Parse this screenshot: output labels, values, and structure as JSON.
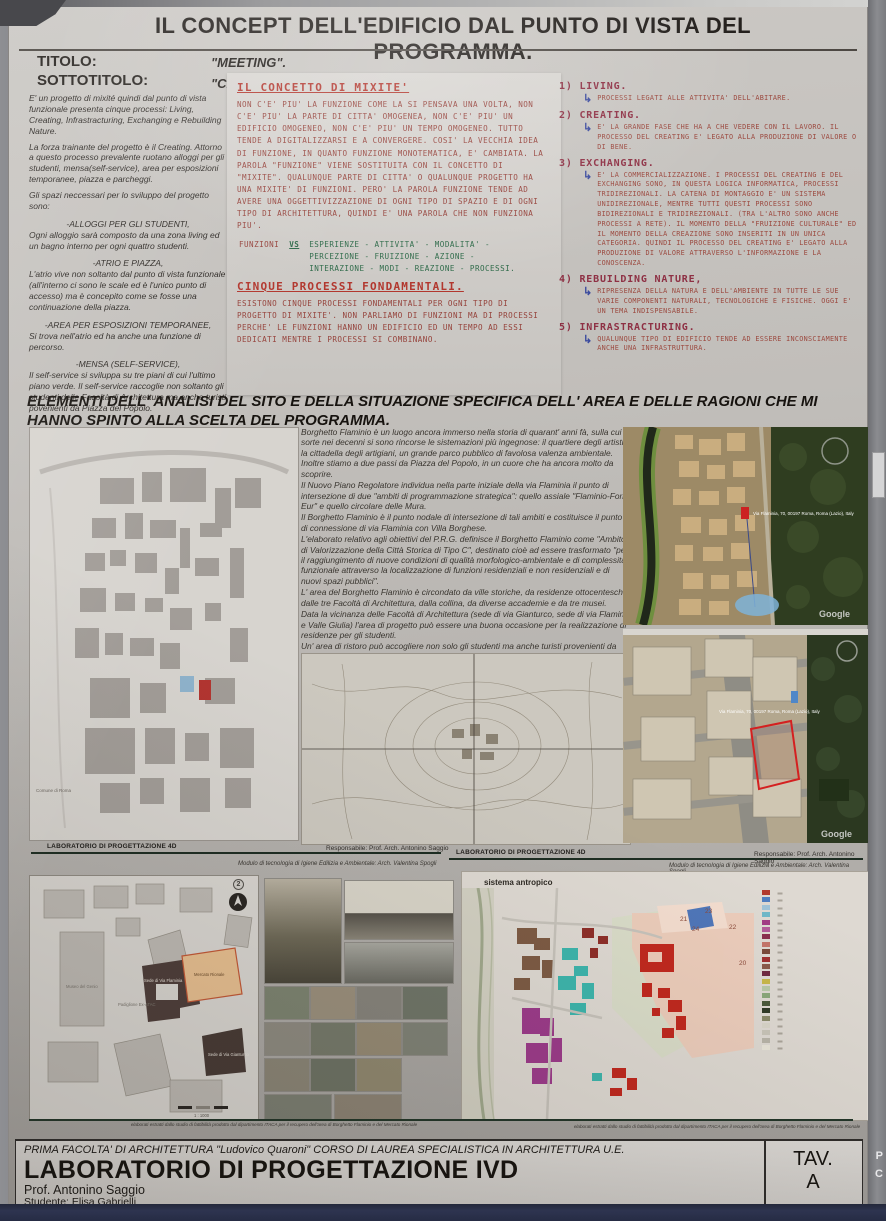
{
  "poster": {
    "header": {
      "title": "IL CONCEPT DELL'EDIFICIO DAL PUNTO DI VISTA DEL PROGRAMMA.",
      "titolo_label": "TITOLO:",
      "titolo_value": "\"MEETING\".",
      "sottotitolo_label": "SOTTOTITOLO:",
      "sottotitolo_value": "\"CREARE, STUDIARE, INCONTRARE: VIVERE INSIEME\"."
    },
    "left_column": {
      "p1": "E' un progetto di mixité quindi dal punto di vista funzionale presenta cinque processi: Living, Creating, Infrastracturing, Exchanging e Rebuilding Nature.",
      "p2": "La forza trainante del progetto è il Creating. Attorno a questo processo prevalente ruotano alloggi per gli studenti, mensa(self-service), area per esposizioni temporanee, piazza e parcheggi.",
      "p3": "Gli spazi neccessari per lo sviluppo del progetto sono:",
      "blocks": [
        {
          "head": "-ALLOGGI PER GLI STUDENTI,",
          "body": "Ogni alloggio sarà composto da una zona living ed un bagno interno per ogni quattro studenti."
        },
        {
          "head": "-ATRIO E PIAZZA,",
          "body": "L'atrio vive non soltanto dal punto di vista funzionale (all'interno ci sono le scale ed è l'unico punto di accesso) ma è concepito come se fosse una continuazione della piazza."
        },
        {
          "head": "-AREA PER ESPOSIZIONI TEMPORANEE,",
          "body": "Si trova nell'atrio ed ha anche una funzione di percorso."
        },
        {
          "head": "-MENSA (SELF-SERVICE),",
          "body": "Il self-service si sviluppa su tre piani di cui l'ultimo piano verde. Il self-service raccoglie non soltanto gli studenti delle Facoltà di Architettura ma anche turisti povenienti da Piazza del Popolo."
        }
      ]
    },
    "notes": {
      "heading1": "IL CONCETTO DI MIXITE'",
      "body1": "NON C'E' PIU' LA FUNZIONE COME LA SI PENSAVA UNA VOLTA, NON C'E' PIU' LA PARTE DI CITTA' OMOGENEA, NON C'E' PIU' UN EDIFICIO OMOGENEO, NON C'E' PIU' UN TEMPO OMOGENEO. TUTTO TENDE A DIGITALIZZARSI E A CONVERGERE. COSI' LA VECCHIA IDEA DI FUNZIONE, IN QUANTO FUNZIONE MONOTEMATICA, E' CAMBIATA. LA PAROLA \"FUNZIONE\" VIENE SOSTITUITA CON IL CONCETTO DI \"MIXITE\". QUALUNQUE PARTE DI CITTA' O QUALUNQUE PROGETTO HA UNA MIXITE' DI FUNZIONI. PERO' LA PAROLA FUNZIONE TENDE AD AVERE UNA OGGETTIVIZZAZIONE DI OGNI TIPO DI SPAZIO E DI OGNI TIPO DI ARCHITETTURA, QUINDI E' UNA PAROLA CHE NON FUNZIONA PIU'.",
      "funzioni_label": "FUNZIONI",
      "vs_label": "VS",
      "vs_list": "ESPERIENZE - ATTIVITA' - MODALITA' - PERCEZIONE - FRUIZIONE - AZIONE - INTERAZIONE - MODI - REAZIONE - PROCESSI.",
      "heading2": "CINQUE PROCESSI FONDAMENTALI.",
      "body2": "ESISTONO CINQUE PROCESSI FONDAMENTALI PER OGNI TIPO DI PROGETTO DI MIXITE'. NON PARLIAMO DI FUNZIONI MA DI PROCESSI PERCHE' LE FUNZIONI HANNO UN EDIFICIO ED UN TEMPO AD ESSI DEDICATI MENTRE I PROCESSI SI COMBINANO."
    },
    "processes": [
      {
        "num": "1)",
        "name": "LIVING.",
        "detail": "PROCESSI LEGATI ALLE ATTIVITA' DELL'ABITARE."
      },
      {
        "num": "2)",
        "name": "CREATING.",
        "detail": "E' LA GRANDE FASE CHE HA A CHE VEDERE CON IL LAVORO. IL PROCESSO DEL CREATING E' LEGATO ALLA PRODUZIONE DI VALORE O DI BENE."
      },
      {
        "num": "3)",
        "name": "EXCHANGING.",
        "detail": "E' LA COMMERCIALIZZAZIONE. I PROCESSI DEL CREATING E DEL EXCHANGING SONO, IN QUESTA LOGICA INFORMATICA, PROCESSI TRIDIREZIONALI. LA CATENA DI MONTAGGIO E' UN SISTEMA UNIDIREZIONALE, MENTRE TUTTI QUESTI PROCESSI SONO BIDIREZIONALI E TRIDIREZIONALI. (TRA L'ALTRO SONO ANCHE PROCESSI A RETE). IL MOMENTO DELLA \"FRUIZIONE CULTURALE\" ED IL MOMENTO DELLA CREAZIONE SONO INSERITI IN UN UNICA CATEGORIA. QUINDI IL PROCESSO DEL CREATING E' LEGATO ALLA PRODUZIONE DI VALORE ATTRAVERSO L'INFORMAZIONE E LA CONOSCENZA."
      },
      {
        "num": "4)",
        "name": "REBUILDING NATURE,",
        "detail": "RIPRESENZA DELLA NATURA E DELL'AMBIENTE IN TUTTE LE SUE VARIE COMPONENTI NATURALI, TECNOLOGICHE E FISICHE. OGGI E' UN TEMA INDISPENSABILE."
      },
      {
        "num": "5)",
        "name": "INFRASTRACTURING.",
        "detail": "QUALUNQUE TIPO DI EDIFICIO TENDE AD ESSERE INCONSCIAMENTE ANCHE UNA INFRASTRUTTURA."
      }
    ],
    "site": {
      "heading": "ELEMENTI DELL' ANALISI DEL SITO E DELLA SITUAZIONE SPECIFICA DELL' AREA E DELLE RAGIONI CHE MI HANNO SPINTO ALLA SCELTA DEL PROGRAMMA.",
      "paragraphs": [
        "Borghetto Flaminio è un luogo ancora immerso nella storia di quarant' anni fà, sulla cui sorte nei decenni si sono rincorse le sistemazioni più ingegnose: il quartiere degli artisti, la cittadella degli artigiani, un grande parco pubblico di favolosa valenza ambientale. Inoltre stiamo a due passi da Piazza del Popolo, in un cuore che ha ancora molto da scoprire.",
        "Il Nuovo Piano Regolatore individua nella parte iniziale della via Flaminia il punto di intersezione di due \"ambiti di programmazione strategica\": quello assiale \"Flaminio-Fori-Eur\" e quello circolare delle Mura.",
        "Il Borghetto Flaminio è il punto nodale di intersezione di tali ambiti e costituisce il punto di connessione di via Flaminia con Villa Borghese.",
        "L'elaborato relativo agli obiettivi del P.R.G. definisce il Borghetto Flaminio come \"Ambito di Valorizzazione della Città Storica di Tipo C\", destinato cioè ad essere trasformato \"per il raggiungimento di nuove condizioni di qualità morfologico-ambientale e di complessità funzionale attraverso la localizzazione di funzioni residenziali e non residenziali e di nuovi spazi pubblici\".",
        "L' area del Borghetto Flaminio è circondato da ville storiche, da residenze ottocentesche, dalle tre Facoltà di Architettura, dalla collina, da diverse accademie e da tre musei.",
        "Data la vicinanza delle Facoltà di Architettura (sede di via Gianturco, sede di via Flaminia e Valle Giulia) l'area di progetto può essere una buona occasione per la realizzazione di residenze per gli studenti.",
        "Un' area di ristoro può accogliere non solo gli studenti ma anche turisti provenienti da Piazza del Popolo."
      ],
      "comune_label": "Comune di Roma"
    },
    "satellite": {
      "geo_label": "Via Flaminia, 70, 00197 Roma, Roma (Lazio), Italy",
      "google_label": "Google"
    },
    "lab_strip": {
      "lab": "LABORATORIO DI PROGETTAZIONE 4D",
      "resp": "Responsabile: Prof. Arch. Antonino Saggio",
      "modulo": "Modulo di tecnologia di Igiene Edilizia e Ambientale: Arch. Valentina Spogli"
    },
    "bottom": {
      "sistema_label": "sistema antropico",
      "marker": "2",
      "map_numbers": [
        "21",
        "23",
        "24",
        "22",
        "20"
      ],
      "plan_labels": {
        "museo": "Museo del Genio",
        "padiglione": "Padiglione Ex-ATAC",
        "sede_flaminia": "Sede di Via Flaminia",
        "mercato": "Mercato Rionale",
        "sede_gianturco": "Sede di Via Gianturco",
        "scala": "1 : 1000"
      },
      "legend_swatches": [
        "#b23a2e",
        "#4f7ec0",
        "#9fc3d8",
        "#6fb8c8",
        "#a23a85",
        "#b45a9a",
        "#8a2f4f",
        "#c4756a",
        "#7a4a3a",
        "#a03030",
        "#8a5a4a",
        "#702a40",
        "#c8b84a",
        "#b8c8a8",
        "#8aa87a",
        "#4a5a3a",
        "#2f3a26",
        "#8a8a6a",
        "#d8d4c8",
        "#c8c4b8",
        "#b8b4a8",
        "#e8e4d8"
      ],
      "caption": "elaborati estratti dallo studio di fattibilità prodotto dal dipartimento ITACA per il recupero dell'area di Borghetto Flaminio e del Mercato Rionale"
    },
    "footer": {
      "line1": "PRIMA FACOLTA' DI ARCHITETTURA \"Ludovico Quaroni\" CORSO DI LAUREA SPECIALISTICA IN ARCHITETTURA U.E.",
      "line2": "LABORATORIO DI PROGETTAZIONE IVD",
      "line3": "Prof. Antonino Saggio",
      "line4": "Studente: Elisa Gabrielli",
      "tav_label": "TAV.",
      "tav_value": "A"
    }
  },
  "frame": {
    "fragment_p": "P",
    "fragment_c": "C"
  }
}
